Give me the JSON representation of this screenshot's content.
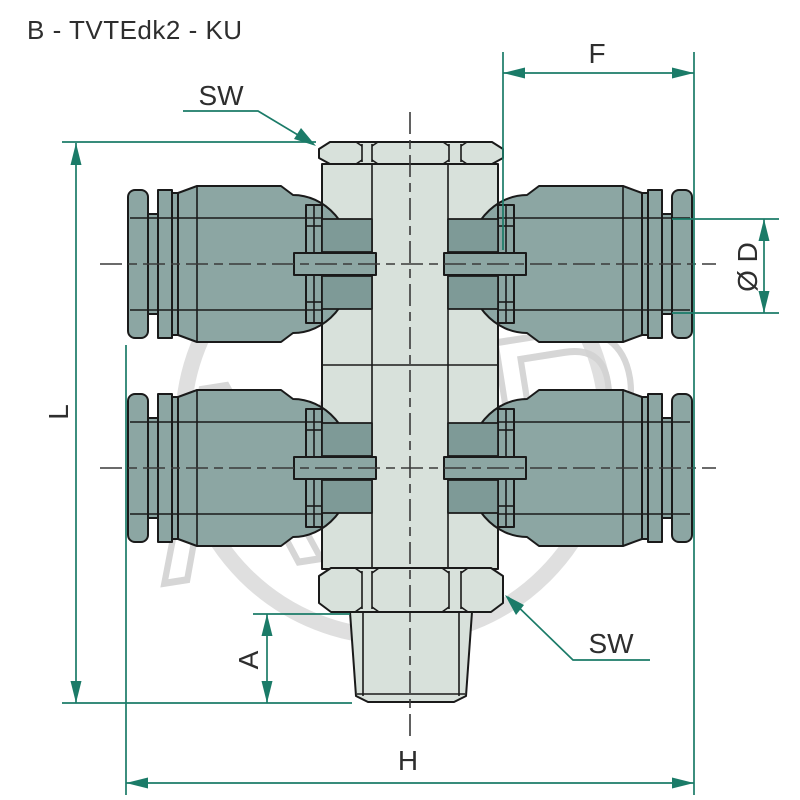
{
  "title": "B - TVTEdk2 - KU",
  "watermark": "AGP",
  "dims": {
    "F": "F",
    "H": "H",
    "L": "L",
    "A": "A",
    "D": "Ø D",
    "SW_top": "SW",
    "SW_bottom": "SW"
  },
  "colors": {
    "accent": "#1b7b68",
    "ink": "#1a1a1a",
    "metal": "#8ca6a3",
    "port": "#7e9a97",
    "body": "#d8e1db",
    "watermark": "#d2d2d2",
    "text": "#2e2e2e",
    "bg": "#ffffff"
  }
}
